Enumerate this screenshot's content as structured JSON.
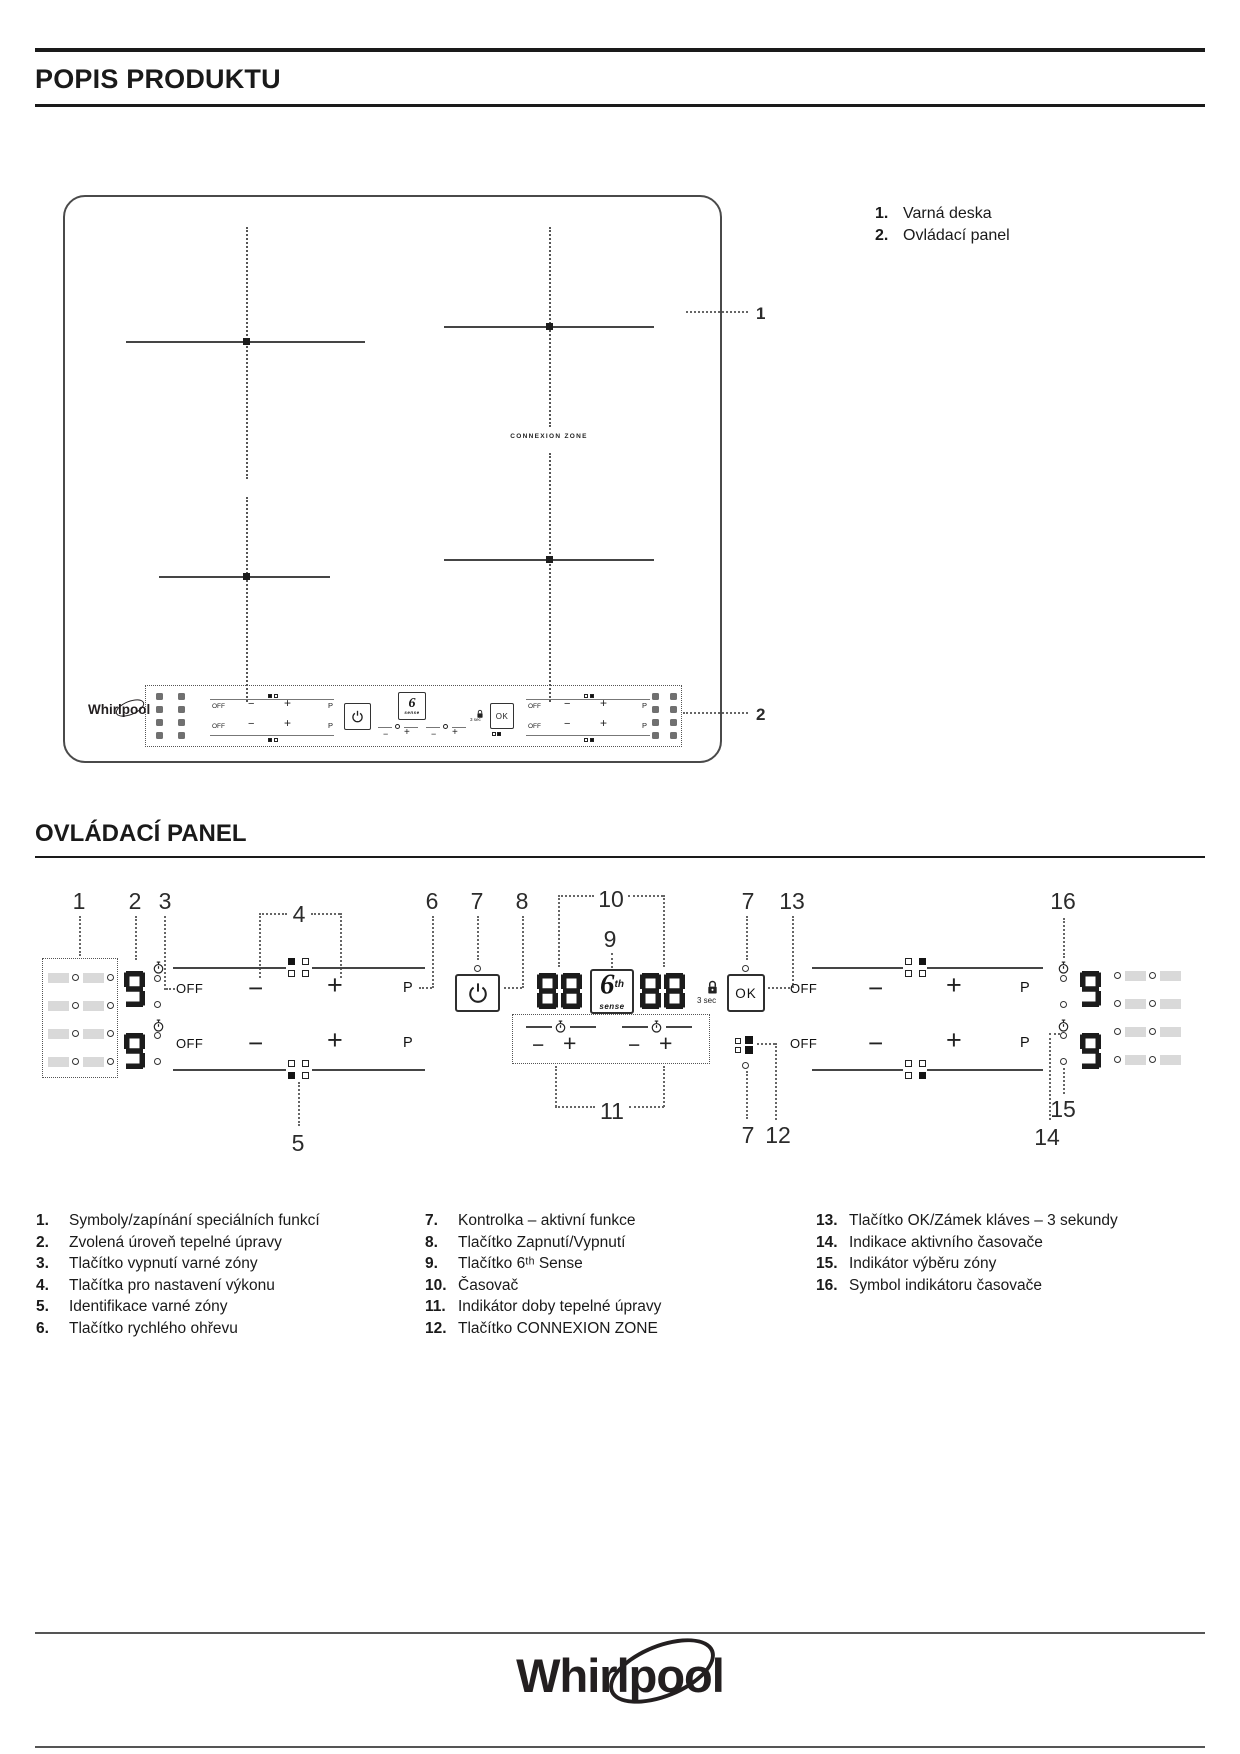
{
  "page": {
    "title": "POPIS PRODUKTU",
    "panel_section_title": "OVLÁDACÍ PANEL"
  },
  "colors": {
    "ink": "#231f20",
    "diagram_line": "#454545",
    "symbol_square_gray": "#d9d9d9"
  },
  "hob_area": {
    "legend": [
      {
        "num": "1.",
        "label": "Varná deska"
      },
      {
        "num": "2.",
        "label": "Ovládací panel"
      }
    ],
    "callout_hob": "1",
    "callout_panel": "2",
    "connexion_zone_label": "CONNEXION ZONE",
    "brand": "Whirlpool"
  },
  "panel": {
    "off": "OFF",
    "minus": "−",
    "plus": "+",
    "boost": "P",
    "ok": "OK",
    "lock_hint": "3 sec",
    "six_sense": {
      "digit": "6",
      "sup": "th",
      "word": "sense"
    },
    "displays": {
      "power_level": "9",
      "timer": "88"
    },
    "callouts": {
      "c1": "1",
      "c2": "2",
      "c3": "3",
      "c4": "4",
      "c5": "5",
      "c6": "6",
      "c7": "7",
      "c8": "8",
      "c9": "9",
      "c10": "10",
      "c11": "11",
      "c12": "12",
      "c13": "13",
      "c14": "14",
      "c15": "15",
      "c16": "16"
    }
  },
  "legend": {
    "col1": [
      {
        "num": "1.",
        "text": "Symboly/zapínání speciálních funkcí"
      },
      {
        "num": "2.",
        "text": "Zvolená úroveň tepelné úpravy"
      },
      {
        "num": "3.",
        "text": "Tlačítko vypnutí varné zóny"
      },
      {
        "num": "4.",
        "text": "Tlačítka pro nastavení výkonu"
      },
      {
        "num": "5.",
        "text": "Identifikace varné zóny"
      },
      {
        "num": "6.",
        "text": "Tlačítko rychlého ohřevu"
      }
    ],
    "col2": [
      {
        "num": "7.",
        "text": "Kontrolka – aktivní funkce"
      },
      {
        "num": "8.",
        "text": "Tlačítko Zapnutí/Vypnutí"
      },
      {
        "num": "9.",
        "text": "Tlačítko 6ᵗʰ Sense"
      },
      {
        "num": "10.",
        "text": "Časovač"
      },
      {
        "num": "11.",
        "text": "Indikátor doby tepelné úpravy"
      },
      {
        "num": "12.",
        "text": "Tlačítko CONNEXION ZONE"
      }
    ],
    "col3": [
      {
        "num": "13.",
        "text": "Tlačítko OK/Zámek kláves – 3 sekundy"
      },
      {
        "num": "14.",
        "text": "Indikace aktivního časovače"
      },
      {
        "num": "15.",
        "text": "Indikátor výběru zóny"
      },
      {
        "num": "16.",
        "text": "Symbol indikátoru časovače"
      }
    ]
  },
  "footer": {
    "brand": "Whirlpool"
  }
}
